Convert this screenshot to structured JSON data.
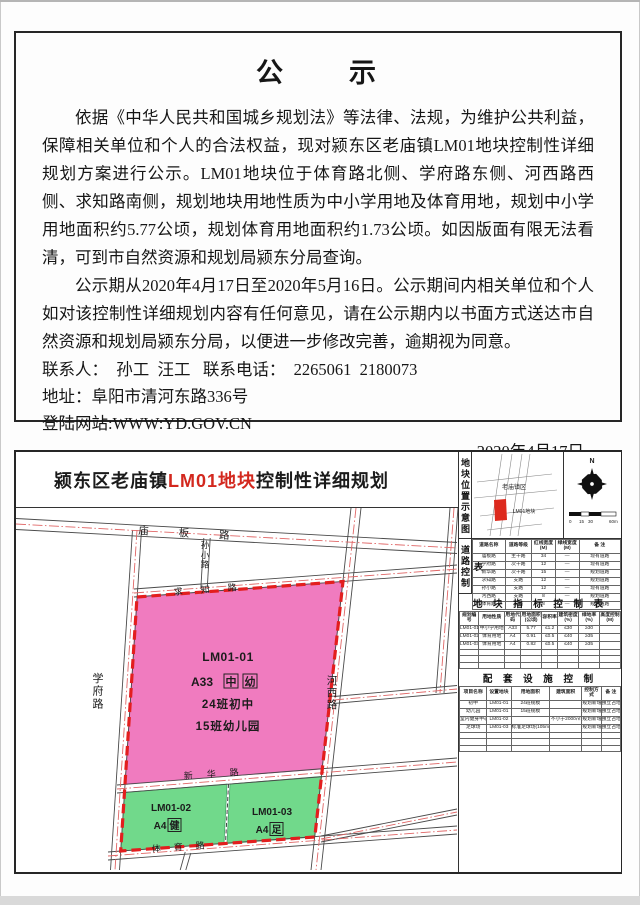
{
  "accent": {
    "red_highlight": "#d3281e",
    "boundary_red": "#e31e1e",
    "parcel_pink": "#f07bbf",
    "parcel_green": "#71d98b"
  },
  "notice": {
    "title": "公　　示",
    "para1": "依据《中华人民共和国城乡规划法》等法律、法规，为维护公共利益，保障相关单位和个人的合法权益，现对颍东区老庙镇LM01地块控制性详细规划方案进行公示。LM01地块位于体育路北侧、学府路东侧、河西路西侧、求知路南侧，规划地块用地性质为中小学用地及体育用地，规划中小学用地面积约5.77公顷，规划体育用地面积约1.73公顷。如因版面有限无法看清，可到市自然资源和规划局颍东分局查询。",
    "para2": "公示期从2020年4月17日至2020年5月16日。公示期间内相关单位和个人如对该控制性详细规划内容有任何意见，请在公示期内以书面方式送达市自然资源和规划局颍东分局，以便进一步修改完善，逾期视为同意。",
    "contact_line": "联系人：  孙工  汪工   联系电话：  2265061  2180073",
    "address_line": "地址：阜阳市清河东路336号",
    "website_line": "登陆网站:WWW:YD.GOV.CN",
    "date": "2020年4月17日"
  },
  "plan": {
    "title_prefix": "颍东区老庙镇",
    "title_highlight": "LM01地块",
    "title_suffix": "控制性详细规划",
    "map_labels": {
      "miaoban_road": "庙板路",
      "sunxiao_lane": "孙小路",
      "qiuzhi_road": "求知路",
      "xuefu_road": "学府路",
      "hexi_road": "河西路",
      "xinhua_road": "新华路",
      "tiyu_road": "体育路"
    },
    "parcel1": {
      "code": "LM01-01",
      "use_code": "A33",
      "tag1": "中",
      "tag2": "幼",
      "line3": "24班初中",
      "line4": "15班幼儿园"
    },
    "parcel2": {
      "code": "LM01-02",
      "use_code": "A4",
      "tag": "健"
    },
    "parcel3": {
      "code": "LM01-03",
      "use_code": "A4",
      "tag": "足"
    },
    "location_panel": {
      "vlabel": "地块位置示意图",
      "town_label": "老庙镇区",
      "parcel_label": "LM01地块",
      "north_label": "N",
      "scale_labels": [
        "0",
        "15",
        "30",
        "60m"
      ]
    },
    "road_table": {
      "vlabel": "道路控制表",
      "col_widths": [
        "22%",
        "18%",
        "16%",
        "16%",
        "28%"
      ],
      "header": [
        "道路名称",
        "道路等级",
        "红线宽度(M)",
        "绿线宽度(M)",
        "备 注"
      ],
      "rows": [
        [
          "庙板路",
          "主干路",
          "34",
          "—",
          "现有道路"
        ],
        [
          "学府路",
          "次干路",
          "12",
          "—",
          "现有道路"
        ],
        [
          "新华路",
          "次干路",
          "15",
          "—",
          "规划道路"
        ],
        [
          "求知路",
          "支路",
          "12",
          "—",
          "规划道路"
        ],
        [
          "孙小路",
          "支路",
          "12",
          "—",
          "现有道路"
        ],
        [
          "河西路",
          "支路",
          "8",
          "—",
          "规划道路"
        ],
        [
          "体育路",
          "支路",
          "8",
          "—",
          "规划道路"
        ]
      ]
    },
    "indicator_table": {
      "title": "地 块 指 标 控 制 表",
      "col_widths": [
        "12%",
        "16%",
        "10%",
        "13%",
        "10%",
        "13%",
        "13%",
        "13%"
      ],
      "header": [
        "规划编号",
        "用地性质",
        "用地代码",
        "用地面积(公顷)",
        "容积率",
        "建筑密度(%)",
        "绿地率(%)",
        "高度控制(M)"
      ],
      "rows": [
        [
          "LM01-01",
          "中小学用地",
          "A33",
          "5.77",
          "≤1.2",
          "≤30",
          "≥30",
          ""
        ],
        [
          "LM01-02",
          "体育用地",
          "A4",
          "0.91",
          "≤0.5",
          "≤40",
          "≥35",
          ""
        ],
        [
          "LM01-03",
          "体育用地",
          "A4",
          "0.82",
          "≤0.5",
          "≤40",
          "≥35",
          ""
        ],
        [
          "",
          "",
          "",
          "",
          "",
          "",
          "",
          ""
        ],
        [
          "",
          "",
          "",
          "",
          "",
          "",
          "",
          ""
        ],
        [
          "",
          "",
          "",
          "",
          "",
          "",
          "",
          ""
        ]
      ]
    },
    "facilities_table": {
      "title": "配 套 设 施 控 制",
      "col_widths": [
        "17%",
        "15%",
        "24%",
        "20%",
        "12%",
        "12%"
      ],
      "header": [
        "项目名称",
        "设置地块",
        "用地面积",
        "建筑面积",
        "控制方式",
        "备 注"
      ],
      "rows": [
        [
          "初中",
          "LM01-01",
          "24班规模",
          "",
          "规划新增",
          "独立占地"
        ],
        [
          "幼儿园",
          "LM01-01",
          "15班规模",
          "",
          "规划新增",
          "独立占地"
        ],
        [
          "室内健身中心",
          "LM01-02",
          "",
          "不小于2000㎡",
          "规划新增",
          "独立占地"
        ],
        [
          "足球场",
          "LM01-03",
          "标准足球场(105m×68m)",
          "",
          "规划新增",
          "独立占地"
        ],
        [
          "",
          "",
          "",
          "",
          "",
          ""
        ],
        [
          "",
          "",
          "",
          "",
          "",
          ""
        ],
        [
          "",
          "",
          "",
          "",
          "",
          ""
        ]
      ]
    }
  }
}
